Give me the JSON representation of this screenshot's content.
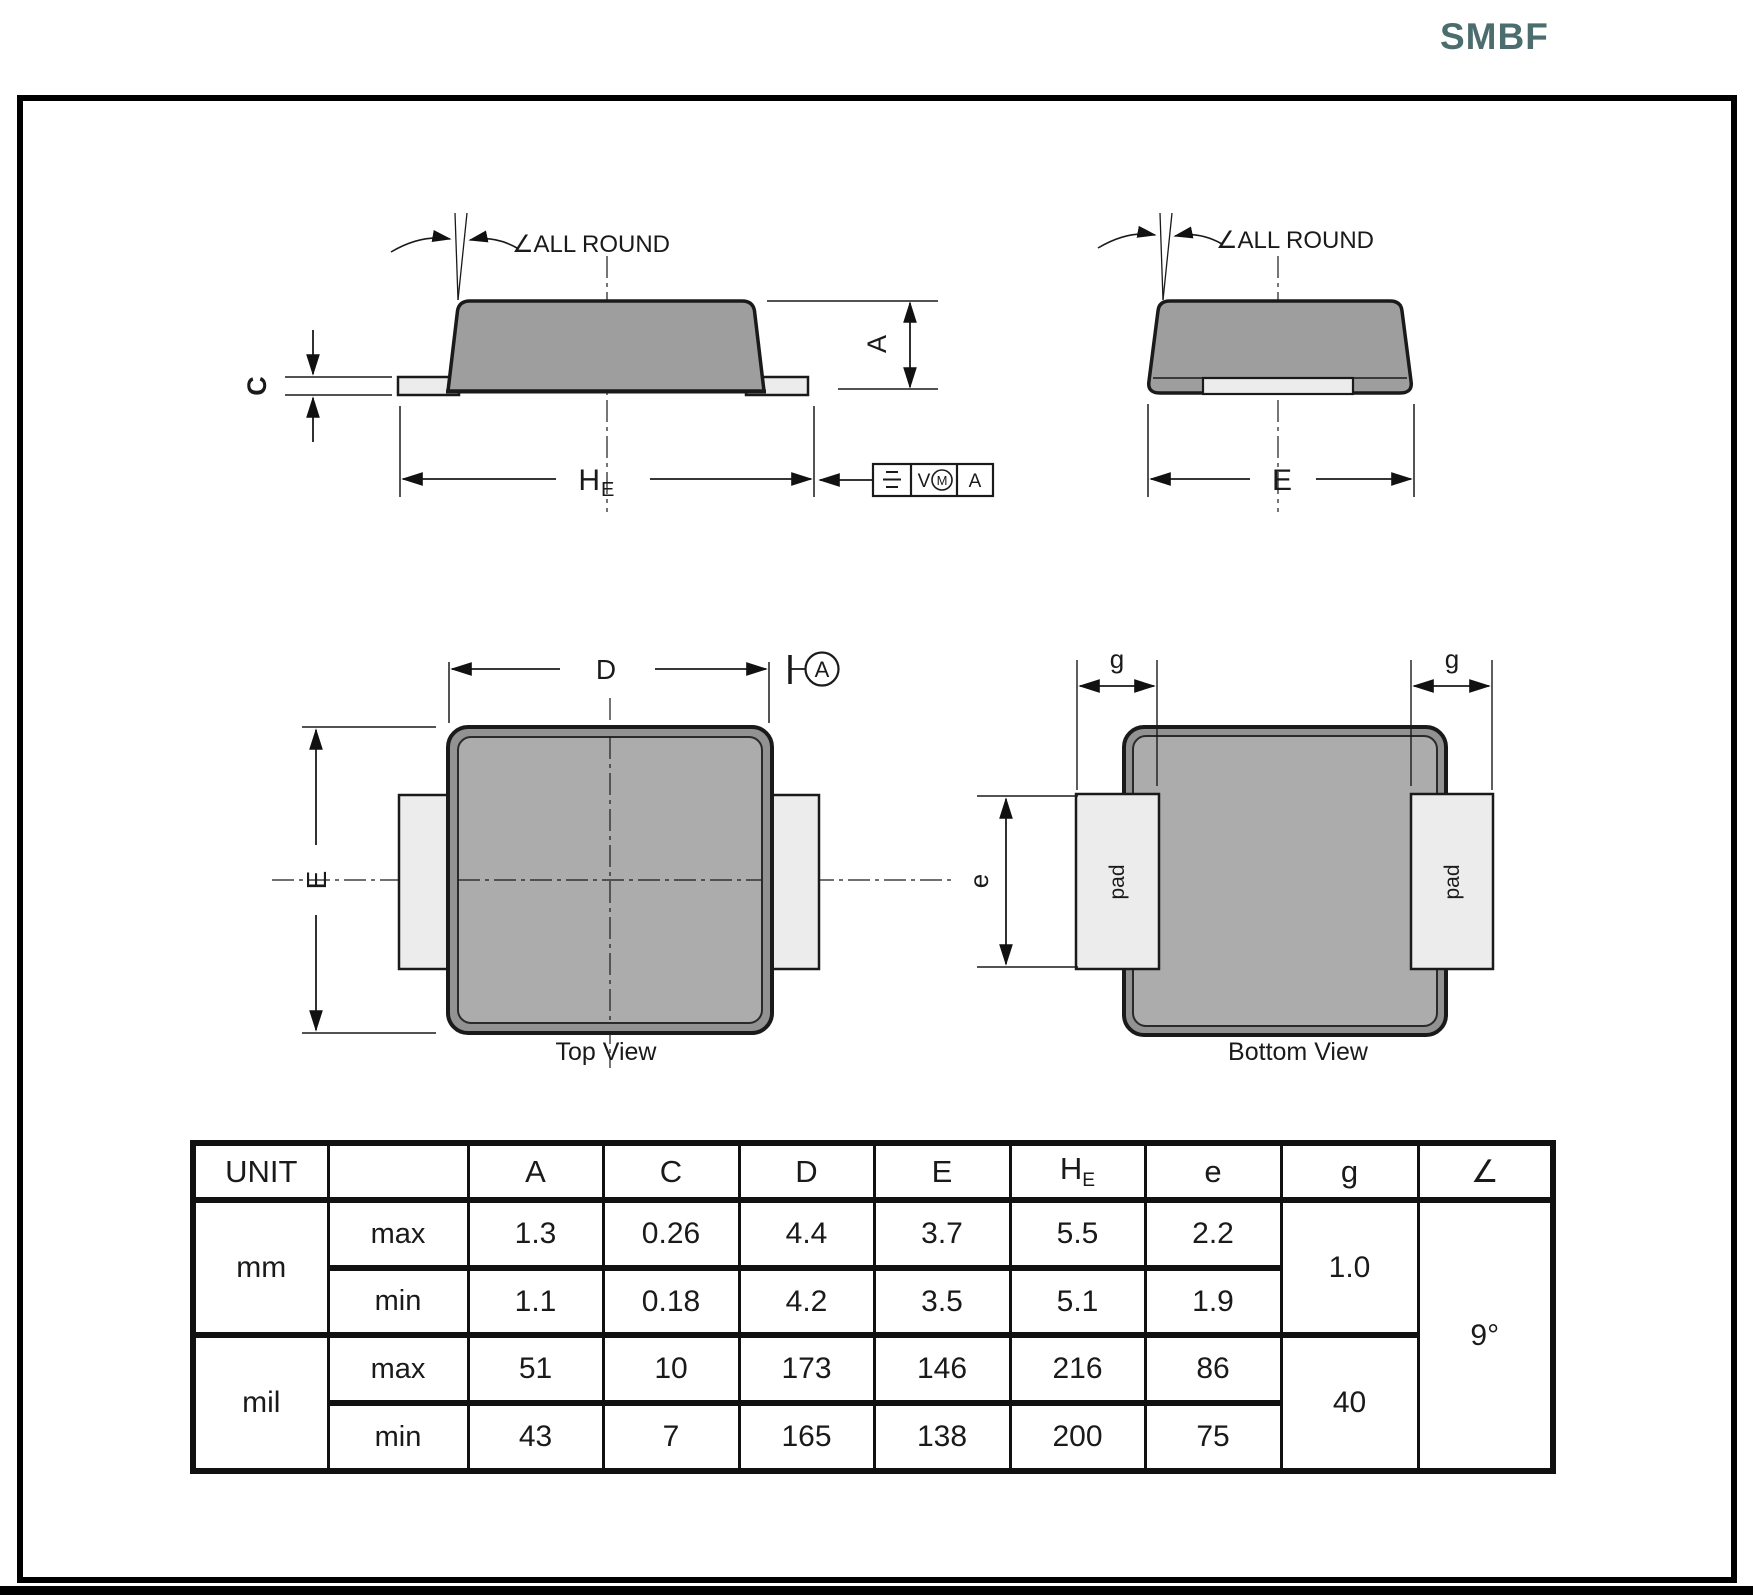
{
  "title": "SMBF",
  "front_view": {
    "angle_note": "∠ALL ROUND",
    "dim_c": "C",
    "dim_a": "A",
    "dim_he_main": "H",
    "dim_he_sub": "E",
    "fcf": {
      "tol_v": "V",
      "mod_m": "M",
      "datum": "A"
    }
  },
  "side_view": {
    "angle_note": "∠ALL ROUND",
    "dim_e": "E"
  },
  "top_view": {
    "label": "Top View",
    "dim_d": "D",
    "dim_e": "E",
    "datum_a": "A"
  },
  "bottom_view": {
    "label": "Bottom View",
    "dim_g_left": "g",
    "dim_g_right": "g",
    "dim_e": "e",
    "pad_left": "pad",
    "pad_right": "pad"
  },
  "table": {
    "unit_header": "UNIT",
    "cols": {
      "a": "A",
      "c": "C",
      "d": "D",
      "e_big": "E",
      "he_main": "H",
      "he_sub": "E",
      "e_small": "e",
      "g": "g",
      "angle": "∠"
    },
    "mm": {
      "label": "mm",
      "max_label": "max",
      "min_label": "min",
      "max": [
        "1.3",
        "0.26",
        "4.4",
        "3.7",
        "5.5",
        "2.2"
      ],
      "min": [
        "1.1",
        "0.18",
        "4.2",
        "3.5",
        "5.1",
        "1.9"
      ],
      "g": "1.0"
    },
    "mil": {
      "label": "mil",
      "max_label": "max",
      "min_label": "min",
      "max": [
        "51",
        "10",
        "173",
        "146",
        "216",
        "86"
      ],
      "min": [
        "43",
        "7",
        "165",
        "138",
        "200",
        "75"
      ],
      "g": "40"
    },
    "angle_value": "9°"
  }
}
